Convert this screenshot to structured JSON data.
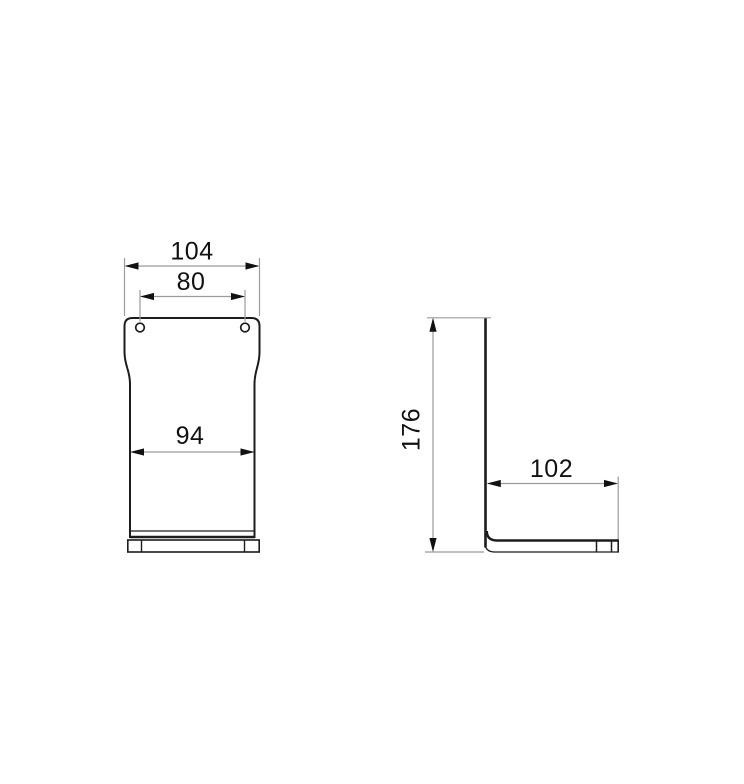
{
  "drawing": {
    "kind": "technical-dimension-drawing",
    "views": {
      "front": {
        "overall_width": "104",
        "hole_spacing": "80",
        "body_width": "94"
      },
      "side": {
        "height": "176",
        "depth": "102"
      }
    },
    "colors": {
      "background": "#ffffff",
      "outline": "#1c1c1c",
      "dimension_line": "#9b9b9b",
      "text": "#111111"
    }
  }
}
